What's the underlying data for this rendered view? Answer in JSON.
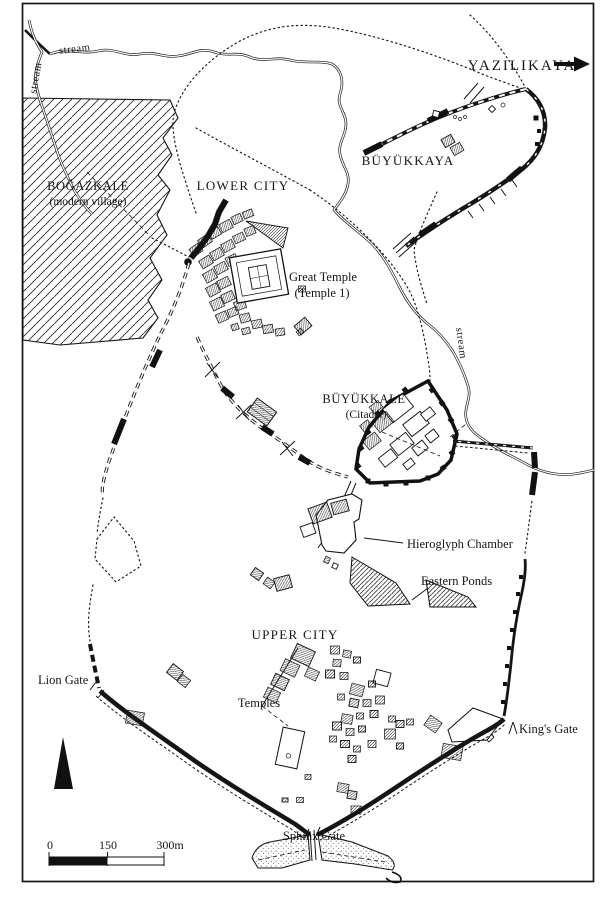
{
  "map": {
    "region_labels": {
      "yazilikaya": "YAZILIKAYA",
      "buyukkaya": "BÜYÜKKAYA",
      "bogazkale": "BOĞAZKALE",
      "bogazkale_sub": "(modern village)",
      "lower_city": "LOWER CITY",
      "great_temple": "Great Temple",
      "great_temple_sub": "(Temple 1)",
      "buyukkale": "BÜYÜKKALE",
      "buyukkale_sub": "(Citadel)",
      "hieroglyph_chamber": "Hieroglyph Chamber",
      "eastern_ponds": "Eastern Ponds",
      "upper_city": "UPPER CITY",
      "temples": "Temples"
    },
    "gates": {
      "lion": "Lion Gate",
      "kings": "King's Gate",
      "sphinx": "Sphinx Gate"
    },
    "streams": {
      "top": "stream",
      "west": "stream",
      "east": "stream"
    },
    "scale_bar": {
      "t0": "0",
      "t150": "150",
      "t300": "300m"
    },
    "colors": {
      "ink": "#151515",
      "paper": "#ffffff"
    }
  }
}
